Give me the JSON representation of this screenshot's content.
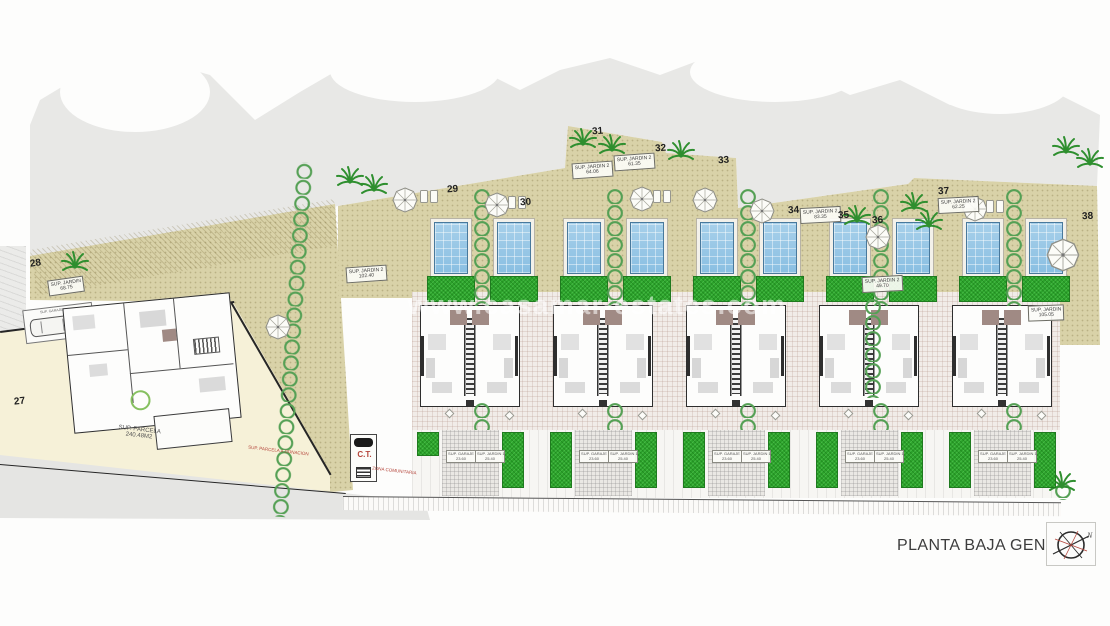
{
  "title": "PLANTA BAJA GENERAL",
  "compass": {
    "n": "N"
  },
  "watermark": {
    "text": "www.casamar-estates.com"
  },
  "plots": {
    "p27": "27",
    "p28": "28",
    "p29": "29",
    "p30": "30",
    "p31": "31",
    "p32": "32",
    "p33": "33",
    "p34": "34",
    "p35": "35",
    "p36": "36",
    "p37": "37",
    "p38": "38"
  },
  "garden_labels": {
    "g28": {
      "l1": "SUP. JARDIN",
      "l2": "68.75"
    },
    "g29": {
      "l1": "SUP. JARDIN 2",
      "l2": "102.40"
    },
    "g31": {
      "l1": "SUP. JARDIN 2",
      "l2": "64.06"
    },
    "g32": {
      "l1": "SUP. JARDIN 2",
      "l2": "61.35"
    },
    "g34": {
      "l1": "SUP. JARDIN 2",
      "l2": "83.35"
    },
    "g36": {
      "l1": "SUP. JARDIN 2",
      "l2": "49.70"
    },
    "g37": {
      "l1": "SUP. JARDIN 2",
      "l2": "62.25"
    },
    "g38": {
      "l1": "SUP. JARDIN",
      "l2": "105.05"
    }
  },
  "unit_labels": {
    "garaje": {
      "l1": "SUP. GARAJE",
      "l2": "23.60"
    },
    "jardin1": {
      "l1": "SUP. JARDIN 1",
      "l2": "25.40"
    }
  },
  "ct": {
    "label": "C.T."
  },
  "notes": {
    "zona": "ZONA COMUNITARIA",
    "donacion": "SUP. PARCELA A DONACION",
    "parcela_l1": "SUP. PARCELA",
    "parcela_l2": "240.48M2",
    "garaje_villa": "SUP. GARAJE"
  },
  "colors": {
    "pool": "#9ccbe8",
    "grass": "#2da32c",
    "sand": "#d9d2a8",
    "red": "#b4443a",
    "wall": "#2e2e2e"
  }
}
